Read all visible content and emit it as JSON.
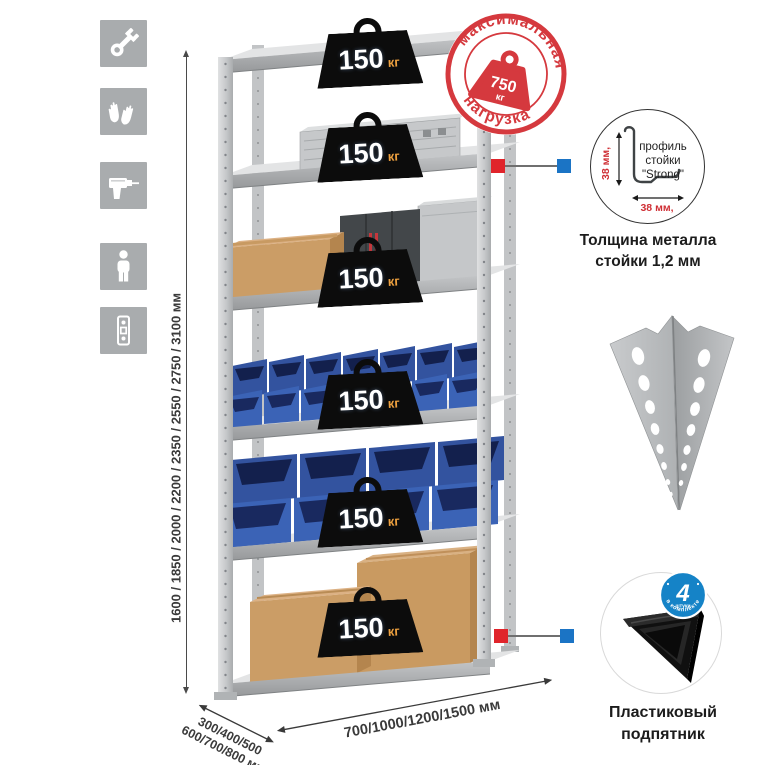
{
  "colors": {
    "accent_red": "#d5393e",
    "connector_red": "#e0242b",
    "connector_blue": "#1b74c5",
    "bin_blue": "#3b63b6",
    "icon_square_gray": "#a9acae"
  },
  "sidebar_icons": {
    "items": [
      {
        "name": "wrench-icon"
      },
      {
        "name": "work-gloves-icon"
      },
      {
        "name": "drill-icon"
      },
      {
        "name": "person-height-icon"
      },
      {
        "name": "perforated-profile-icon"
      }
    ]
  },
  "height_dimension": {
    "label": "1600 / 1850 / 2000 / 2200 / 2350 / 2550 / 2750 / 3100 мм"
  },
  "rack": {
    "load_value": "150",
    "load_unit": "кг",
    "shelves": [
      {
        "contents": "empty"
      },
      {
        "contents": "aluminum case"
      },
      {
        "contents": "cardboard box and metal cases"
      },
      {
        "contents": "small blue stacking bins"
      },
      {
        "contents": "large blue stacking bins"
      },
      {
        "contents": "cardboard boxes"
      }
    ]
  },
  "max_load_stamp": {
    "top_text": "максимальная",
    "bottom_text": "нагрузка",
    "value": "750",
    "unit": "кг"
  },
  "profile_detail": {
    "label_line1": "профиль",
    "label_line2": "стойки",
    "label_line3": "\"Strong\"",
    "vertical_dim": "38 мм,",
    "horizontal_dim": "38 мм,",
    "caption_line1": "Толщина металла",
    "caption_line2": "стойки 1,2 мм"
  },
  "foot_detail": {
    "badge_value": "4",
    "badge_subtext": "штуки",
    "badge_arc": "в комплекте",
    "caption_line1": "Пластиковый",
    "caption_line2": "подпятник"
  },
  "depth_dimension": {
    "line1": "300/400/500",
    "line2": "600/700/800 мм"
  },
  "width_dimension": {
    "label": "700/1000/1200/1500 мм"
  }
}
